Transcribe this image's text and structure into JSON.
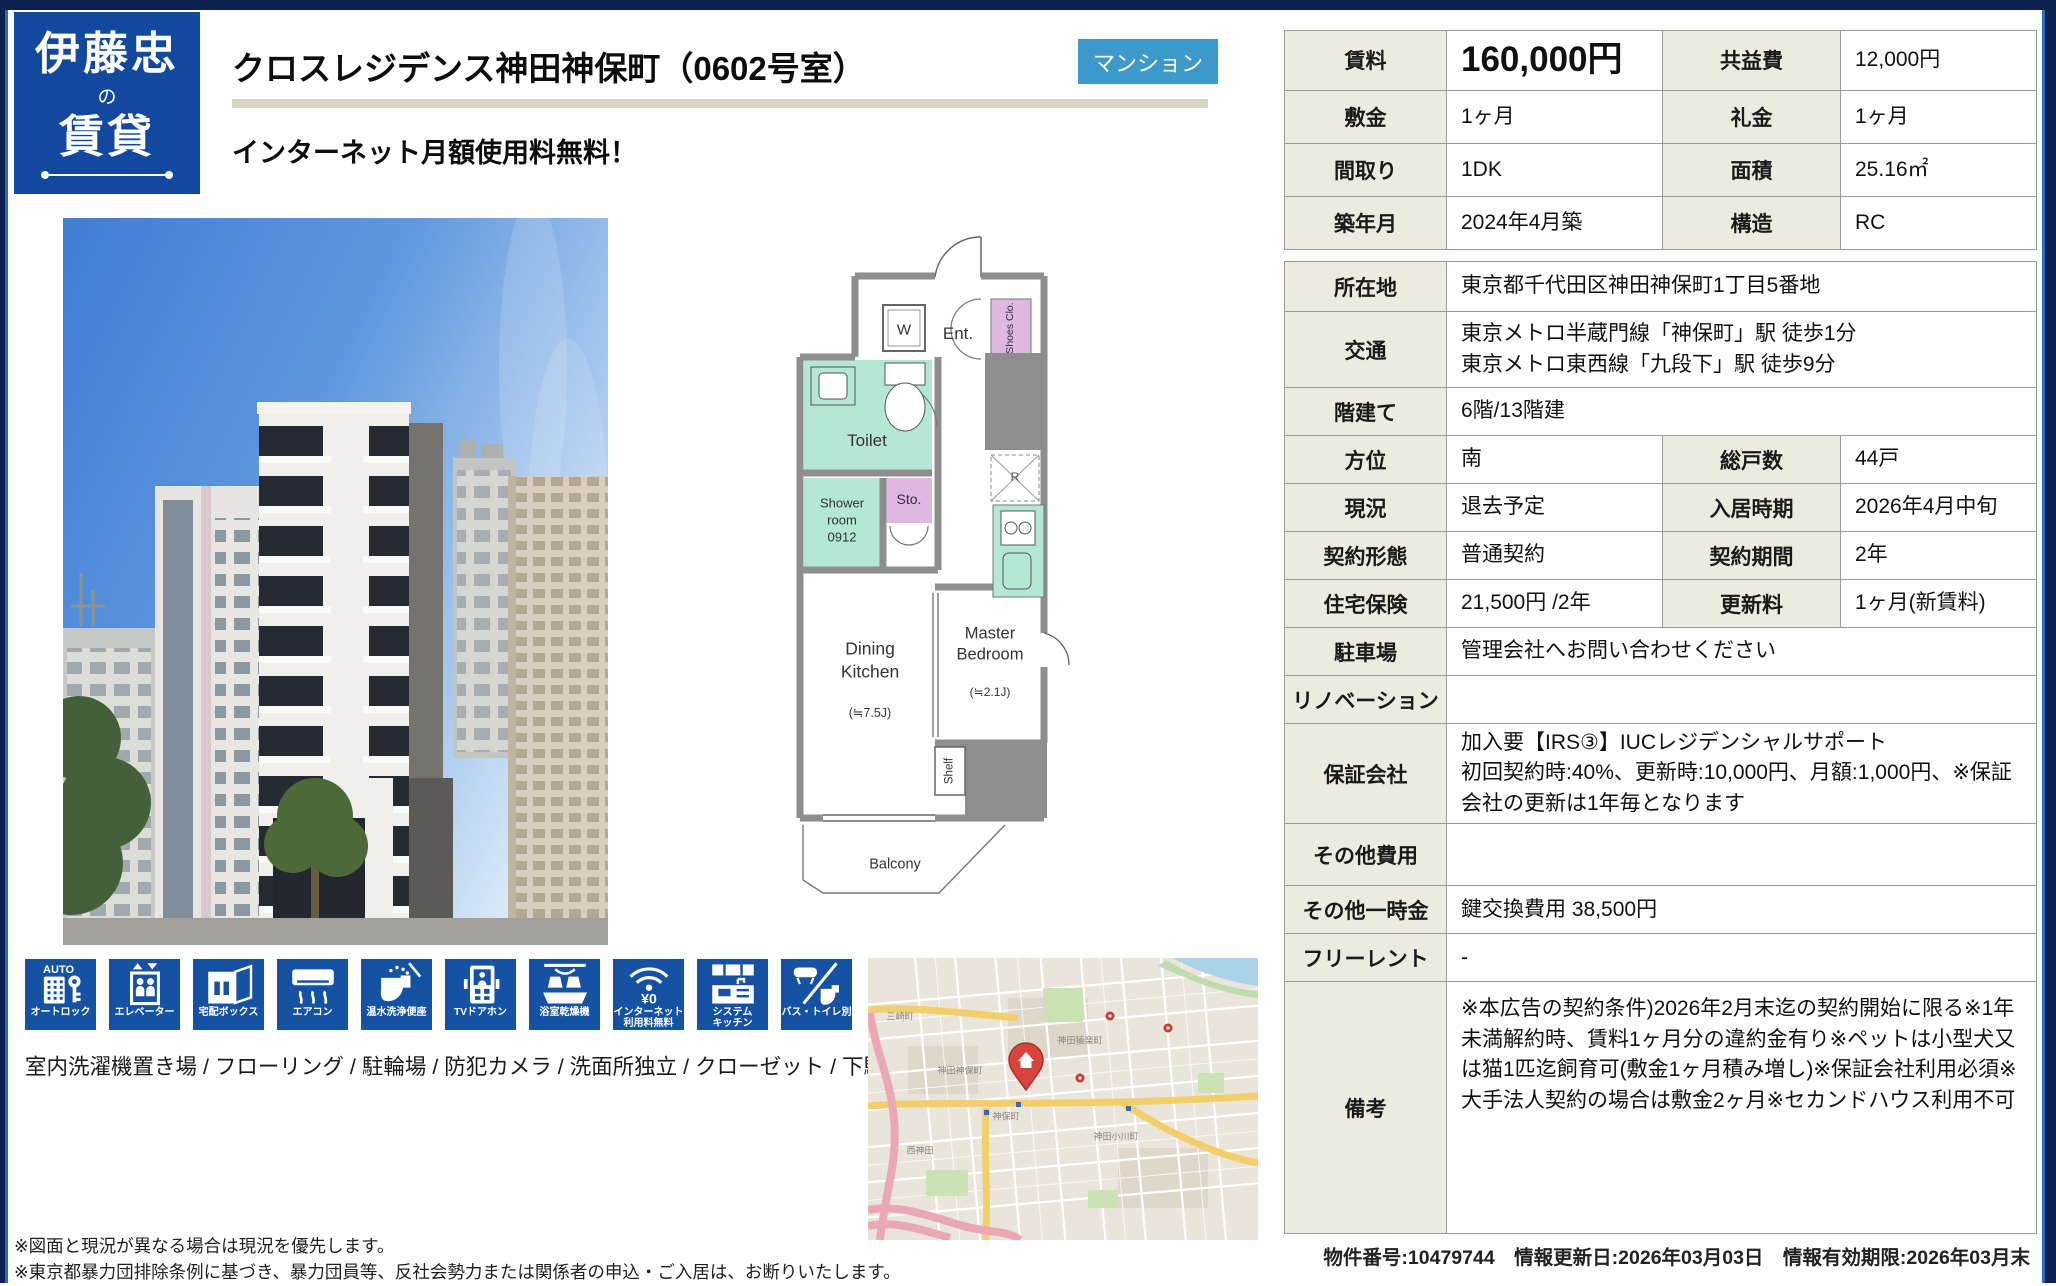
{
  "brand": {
    "line1": "伊藤忠",
    "particle": "の",
    "line2": "賃貸"
  },
  "header": {
    "title": "クロスレジデンス神田神保町（0602号室）",
    "badge": "マンション",
    "subtitle": "インターネット月額使用料無料！"
  },
  "colors": {
    "brand_blue": "#12489e",
    "badge_blue": "#3d99c9",
    "tile_blue": "#1652a3",
    "label_cell_bg": "#edeae0",
    "title_rule": "#d8d5c7"
  },
  "summary_table": {
    "rows": [
      [
        {
          "k": "label",
          "v": "賃料"
        },
        {
          "k": "value",
          "v": "160,000円"
        },
        {
          "k": "label",
          "v": "共益費"
        },
        {
          "k": "value",
          "v": "12,000円"
        }
      ],
      [
        {
          "k": "label",
          "v": "敷金"
        },
        {
          "k": "value",
          "v": "1ヶ月"
        },
        {
          "k": "label",
          "v": "礼金"
        },
        {
          "k": "value",
          "v": "1ヶ月"
        }
      ],
      [
        {
          "k": "label",
          "v": "間取り"
        },
        {
          "k": "value",
          "v": "1DK"
        },
        {
          "k": "label",
          "v": "面積"
        },
        {
          "k": "value",
          "v": "25.16㎡"
        }
      ],
      [
        {
          "k": "label",
          "v": "築年月"
        },
        {
          "k": "value",
          "v": "2024年4月築"
        },
        {
          "k": "label",
          "v": "構造"
        },
        {
          "k": "value",
          "v": "RC"
        }
      ]
    ]
  },
  "detail_table": {
    "rows": [
      [
        {
          "k": "label",
          "v": "所在地"
        },
        {
          "k": "value",
          "v": "東京都千代田区神田神保町1丁目5番地",
          "span": 3
        }
      ],
      [
        {
          "k": "label",
          "v": "交通"
        },
        {
          "k": "value",
          "v": "東京メトロ半蔵門線「神保町」駅 徒歩1分\n東京メトロ東西線「九段下」駅 徒歩9分",
          "span": 3
        }
      ],
      [
        {
          "k": "label",
          "v": "階建て"
        },
        {
          "k": "value",
          "v": "6階/13階建",
          "span": 3
        }
      ],
      [
        {
          "k": "label",
          "v": "方位"
        },
        {
          "k": "value",
          "v": "南"
        },
        {
          "k": "label",
          "v": "総戸数"
        },
        {
          "k": "value",
          "v": "44戸"
        }
      ],
      [
        {
          "k": "label",
          "v": "現況"
        },
        {
          "k": "value",
          "v": "退去予定"
        },
        {
          "k": "label",
          "v": "入居時期"
        },
        {
          "k": "value",
          "v": "2026年4月中旬"
        }
      ],
      [
        {
          "k": "label",
          "v": "契約形態"
        },
        {
          "k": "value",
          "v": "普通契約"
        },
        {
          "k": "label",
          "v": "契約期間"
        },
        {
          "k": "value",
          "v": "2年"
        }
      ],
      [
        {
          "k": "label",
          "v": "住宅保険"
        },
        {
          "k": "value",
          "v": "21,500円 /2年"
        },
        {
          "k": "label",
          "v": "更新料"
        },
        {
          "k": "value",
          "v": "1ヶ月(新賃料)"
        }
      ],
      [
        {
          "k": "label",
          "v": "駐車場"
        },
        {
          "k": "value",
          "v": "管理会社へお問い合わせください",
          "span": 3
        }
      ],
      [
        {
          "k": "label",
          "v": "リノベーション"
        },
        {
          "k": "value",
          "v": "",
          "span": 3
        }
      ],
      [
        {
          "k": "label",
          "v": "保証会社"
        },
        {
          "k": "value",
          "v": "加入要【IRS③】IUCレジデンシャルサポート\n初回契約時:40%、更新時:10,000円、月額:1,000円、※保証会社の更新は1年毎となります",
          "span": 3
        }
      ],
      [
        {
          "k": "label",
          "v": "その他費用"
        },
        {
          "k": "value",
          "v": "",
          "span": 3
        }
      ],
      [
        {
          "k": "label",
          "v": "その他一時金"
        },
        {
          "k": "value",
          "v": "鍵交換費用 38,500円",
          "span": 3
        }
      ],
      [
        {
          "k": "label",
          "v": "フリーレント"
        },
        {
          "k": "value",
          "v": "-",
          "span": 3
        }
      ],
      [
        {
          "k": "label",
          "v": "備考"
        },
        {
          "k": "value",
          "v": "※本広告の契約条件)2026年2月末迄の契約開始に限る※1年未満解約時、賃料1ヶ月分の違約金有り※ペットは小型犬又は猫1匹迄飼育可(敷金1ヶ月積み増し)※保証会社利用必須※大手法人契約の場合は敷金2ヶ月※セカンドハウス利用不可",
          "span": 3
        }
      ]
    ]
  },
  "floorplan": {
    "w": "W",
    "ent": "Ent.",
    "shoes": "Shoes Clo.",
    "toilet": "Toilet",
    "shower": "Shower\nroom\n0912",
    "sto": "Sto.",
    "fridge": "R",
    "dk": "Dining\nKitchen",
    "dk_size": "(≒7.5J)",
    "bedroom": "Master\nBedroom",
    "bedroom_size": "(≒2.1J)",
    "shelf": "Shelf",
    "balcony": "Balcony"
  },
  "features": {
    "icons": [
      "オートロック",
      "エレベーター",
      "宅配ボックス",
      "エアコン",
      "温水洗浄便座",
      "TVドアホン",
      "浴室乾燥機",
      "インターネット\n利用料無料",
      "システム\nキッチン",
      "バス・トイレ別"
    ],
    "amenities": "室内洗濯機置き場 / フローリング / 駐輪場 / 防犯カメラ / 洗面所独立 / クローゼット / 下駄箱"
  },
  "map": {
    "labels": [
      "三崎町",
      "神田猿楽町",
      "神田神保町",
      "神保町",
      "西神田",
      "神田小川町"
    ]
  },
  "notes": {
    "line1": "※図面と現況が異なる場合は現況を優先します。",
    "line2": "※東京都暴力団排除条例に基づき、暴力団員等、反社会勢力または関係者の申込・ご入居は、お断りいたします。"
  },
  "footer": {
    "meta": "物件番号:10479744　情報更新日:2026年03月03日　情報有効期限:2026年03月末"
  }
}
